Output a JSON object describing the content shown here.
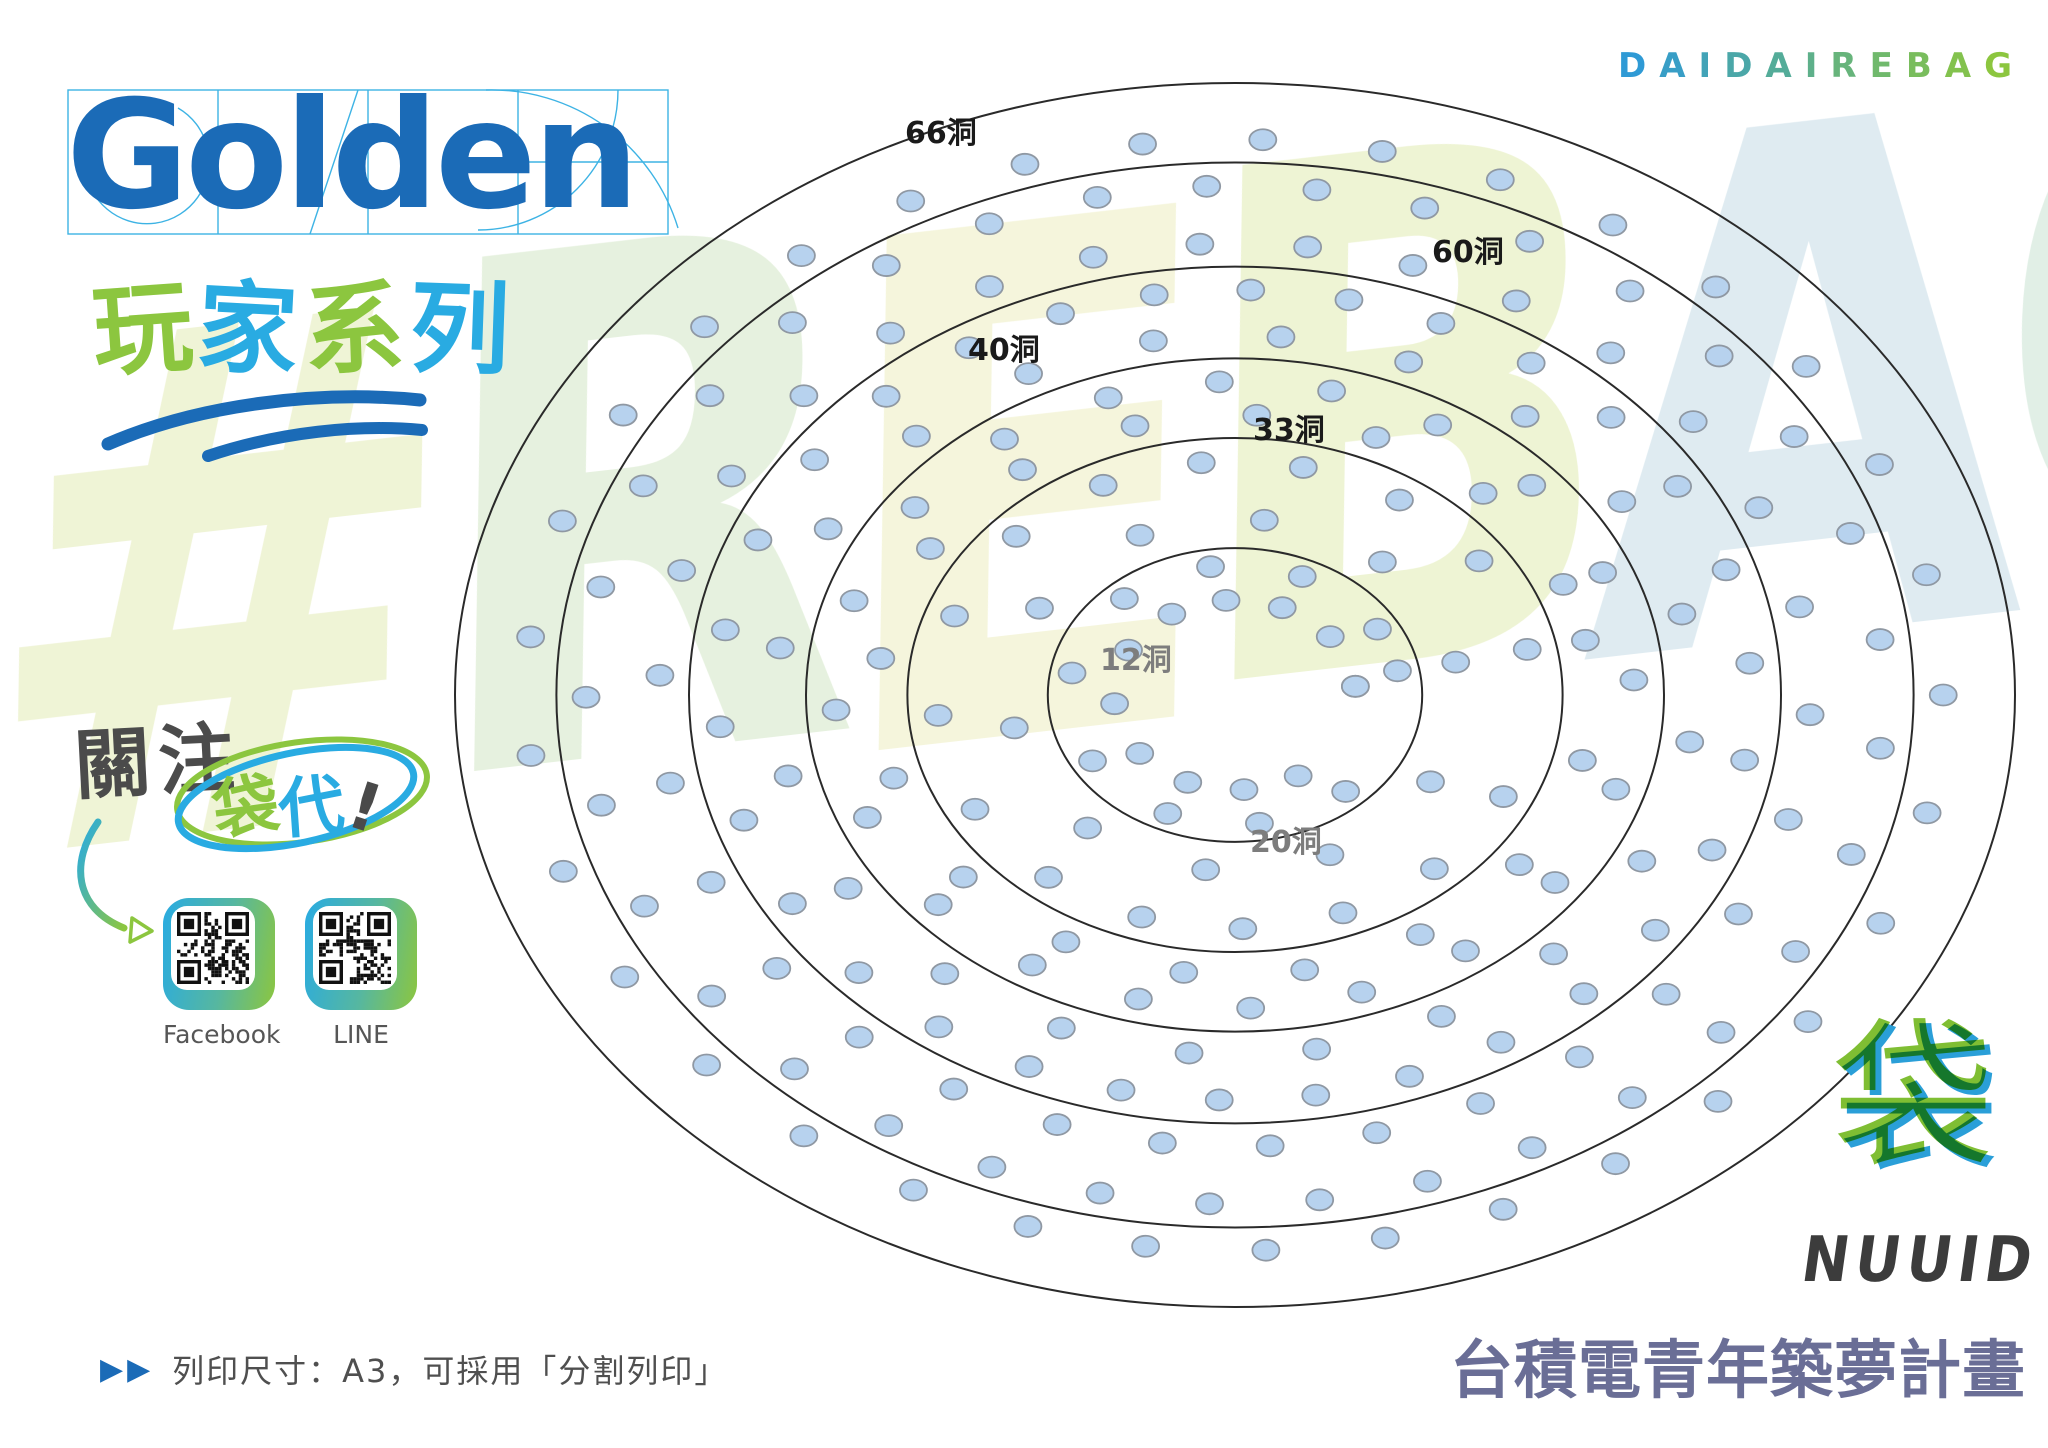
{
  "page": {
    "width": 2048,
    "height": 1448,
    "background": "#ffffff"
  },
  "header": {
    "brand_logo_text": "Golden",
    "series_title_chars": [
      {
        "char": "玩",
        "color": "#8cc63f"
      },
      {
        "char": "家",
        "color": "#29abe2"
      },
      {
        "char": "系",
        "color": "#8cc63f"
      },
      {
        "char": "列",
        "color": "#29abe2"
      }
    ],
    "top_right_brand": "DAIDAIREBAG",
    "top_right_gradient": {
      "from": "#2f9ad5",
      "to": "#8cc63f"
    }
  },
  "watermark": {
    "text": "#REBAG",
    "letters": [
      {
        "char": "#",
        "color": "#edf2cf"
      },
      {
        "char": "R",
        "color": "#e2efd9"
      },
      {
        "char": "E",
        "color": "#f3f4d6"
      },
      {
        "char": "B",
        "color": "#ebf2cc"
      },
      {
        "char": "A",
        "color": "#d9e8ef"
      },
      {
        "char": "G",
        "color": "#dcede2"
      }
    ]
  },
  "diagram": {
    "center_x": 1235,
    "center_y": 695,
    "outer_rx": 780,
    "outer_ry": 612,
    "ellipse_fractions": [
      1.0,
      0.87,
      0.7,
      0.55,
      0.42,
      0.24
    ],
    "line_color": "#2a2a2a",
    "dot_fill": "#b7d2ee",
    "dot_stroke": "#8f98a3",
    "dot_rx": 13.5,
    "dot_ry": 10.5,
    "rings": [
      {
        "label": "66洞",
        "count": 66,
        "outer_f": 0.908,
        "inner_f": 0.832,
        "label_x": 905,
        "label_y": 143,
        "label_color": "#1a1a1a"
      },
      {
        "label": "60洞",
        "count": 60,
        "outer_f": 0.738,
        "inner_f": 0.662,
        "label_x": 1432,
        "label_y": 262,
        "label_color": "#1a1a1a"
      },
      {
        "label": "40洞",
        "count": 40,
        "outer_f": 0.588,
        "inner_f": 0.512,
        "label_x": 968,
        "label_y": 360,
        "label_color": "#1a1a1a"
      },
      {
        "label": "33洞",
        "count": 33,
        "outer_f": 0.458,
        "inner_f": 0.382,
        "label_x": 1253,
        "label_y": 440,
        "label_color": "#1a1a1a"
      },
      {
        "label": "20洞",
        "count": 20,
        "outer_f": 0.288,
        "inner_f": 0.212,
        "label_x": 1250,
        "label_y": 852,
        "label_color": "#7d7d7d"
      },
      {
        "label": "12洞",
        "count": 12,
        "outer_f": 0.155,
        "inner_f": 0.155,
        "label_x": 1100,
        "label_y": 670,
        "label_color": "#7d7d7d"
      }
    ]
  },
  "follow": {
    "prefix": "關注",
    "circled_chars": [
      {
        "char": "袋",
        "color": "#8cc63f"
      },
      {
        "char": "代",
        "color": "#29abe2"
      }
    ],
    "bang": "!"
  },
  "qr": {
    "items": [
      {
        "label": "Facebook"
      },
      {
        "label": "LINE"
      }
    ]
  },
  "footer": {
    "bag_glyph": "袋",
    "brand": "NUUID",
    "campaign": "台積電青年築夢計畫",
    "print_note": "列印尺寸：A3，可採用「分割列印」",
    "note_marker": "▶▶"
  },
  "colors": {
    "golden_blue": "#1b6bb7",
    "sky_blue": "#29abe2",
    "green": "#8cc63f",
    "guide_line": "#29abe2",
    "note_text": "#4f4f4f"
  }
}
